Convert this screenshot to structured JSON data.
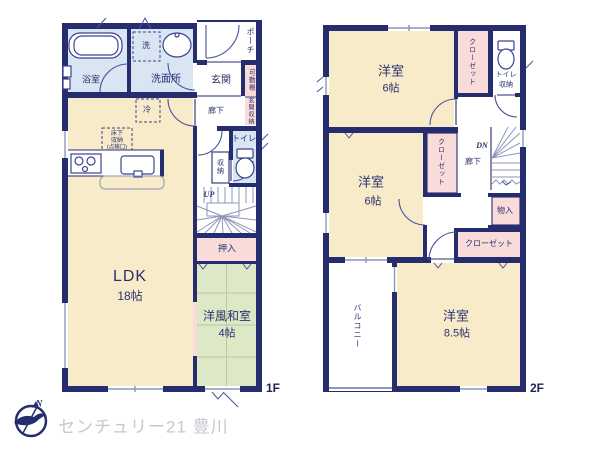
{
  "palette": {
    "wall": "#262d6e",
    "cream": "#f8ebc9",
    "green": "#dde9c6",
    "pink": "#f9dbda",
    "blue": "#d9e5f2",
    "line": "#8d96bb",
    "tatami": "#bcc8a4",
    "gray_text": "#c7c7d0",
    "label": "#2a3170"
  },
  "f1": {
    "floor": "1F",
    "bath": "浴室",
    "wash": "洗",
    "washroom": "洗面所",
    "genkan": "玄関",
    "porch": "ポーチ",
    "kadou": "可動棚",
    "gshuno": "玄関収納",
    "rouka": "廊下",
    "toilet": "トイレ",
    "shuno": "収納",
    "up": "UP",
    "rei": "冷",
    "yuka1": "床下",
    "yuka2": "収納",
    "yuka3": "(点検口)",
    "ldk": "LDK",
    "ldk_size": "18帖",
    "oshiire": "押入",
    "washitsu": "洋風和室",
    "washitsu_size": "4帖"
  },
  "f2": {
    "floor": "2F",
    "room_a": "洋室",
    "room_a_size": "6帖",
    "closet_a": "クローゼット",
    "toilet": "トイレ",
    "toilet_shuno": "収納",
    "room_b": "洋室",
    "room_b_size": "6帖",
    "closet_b": "クローゼット",
    "dn": "DN",
    "rouka": "廊下",
    "monoire": "物入",
    "closet_c": "クローゼット",
    "room_c": "洋室",
    "room_c_size": "8.5帖",
    "balcony": "バルコニー"
  },
  "footer": {
    "brand": "センチュリー21 豊川",
    "north": "N"
  }
}
